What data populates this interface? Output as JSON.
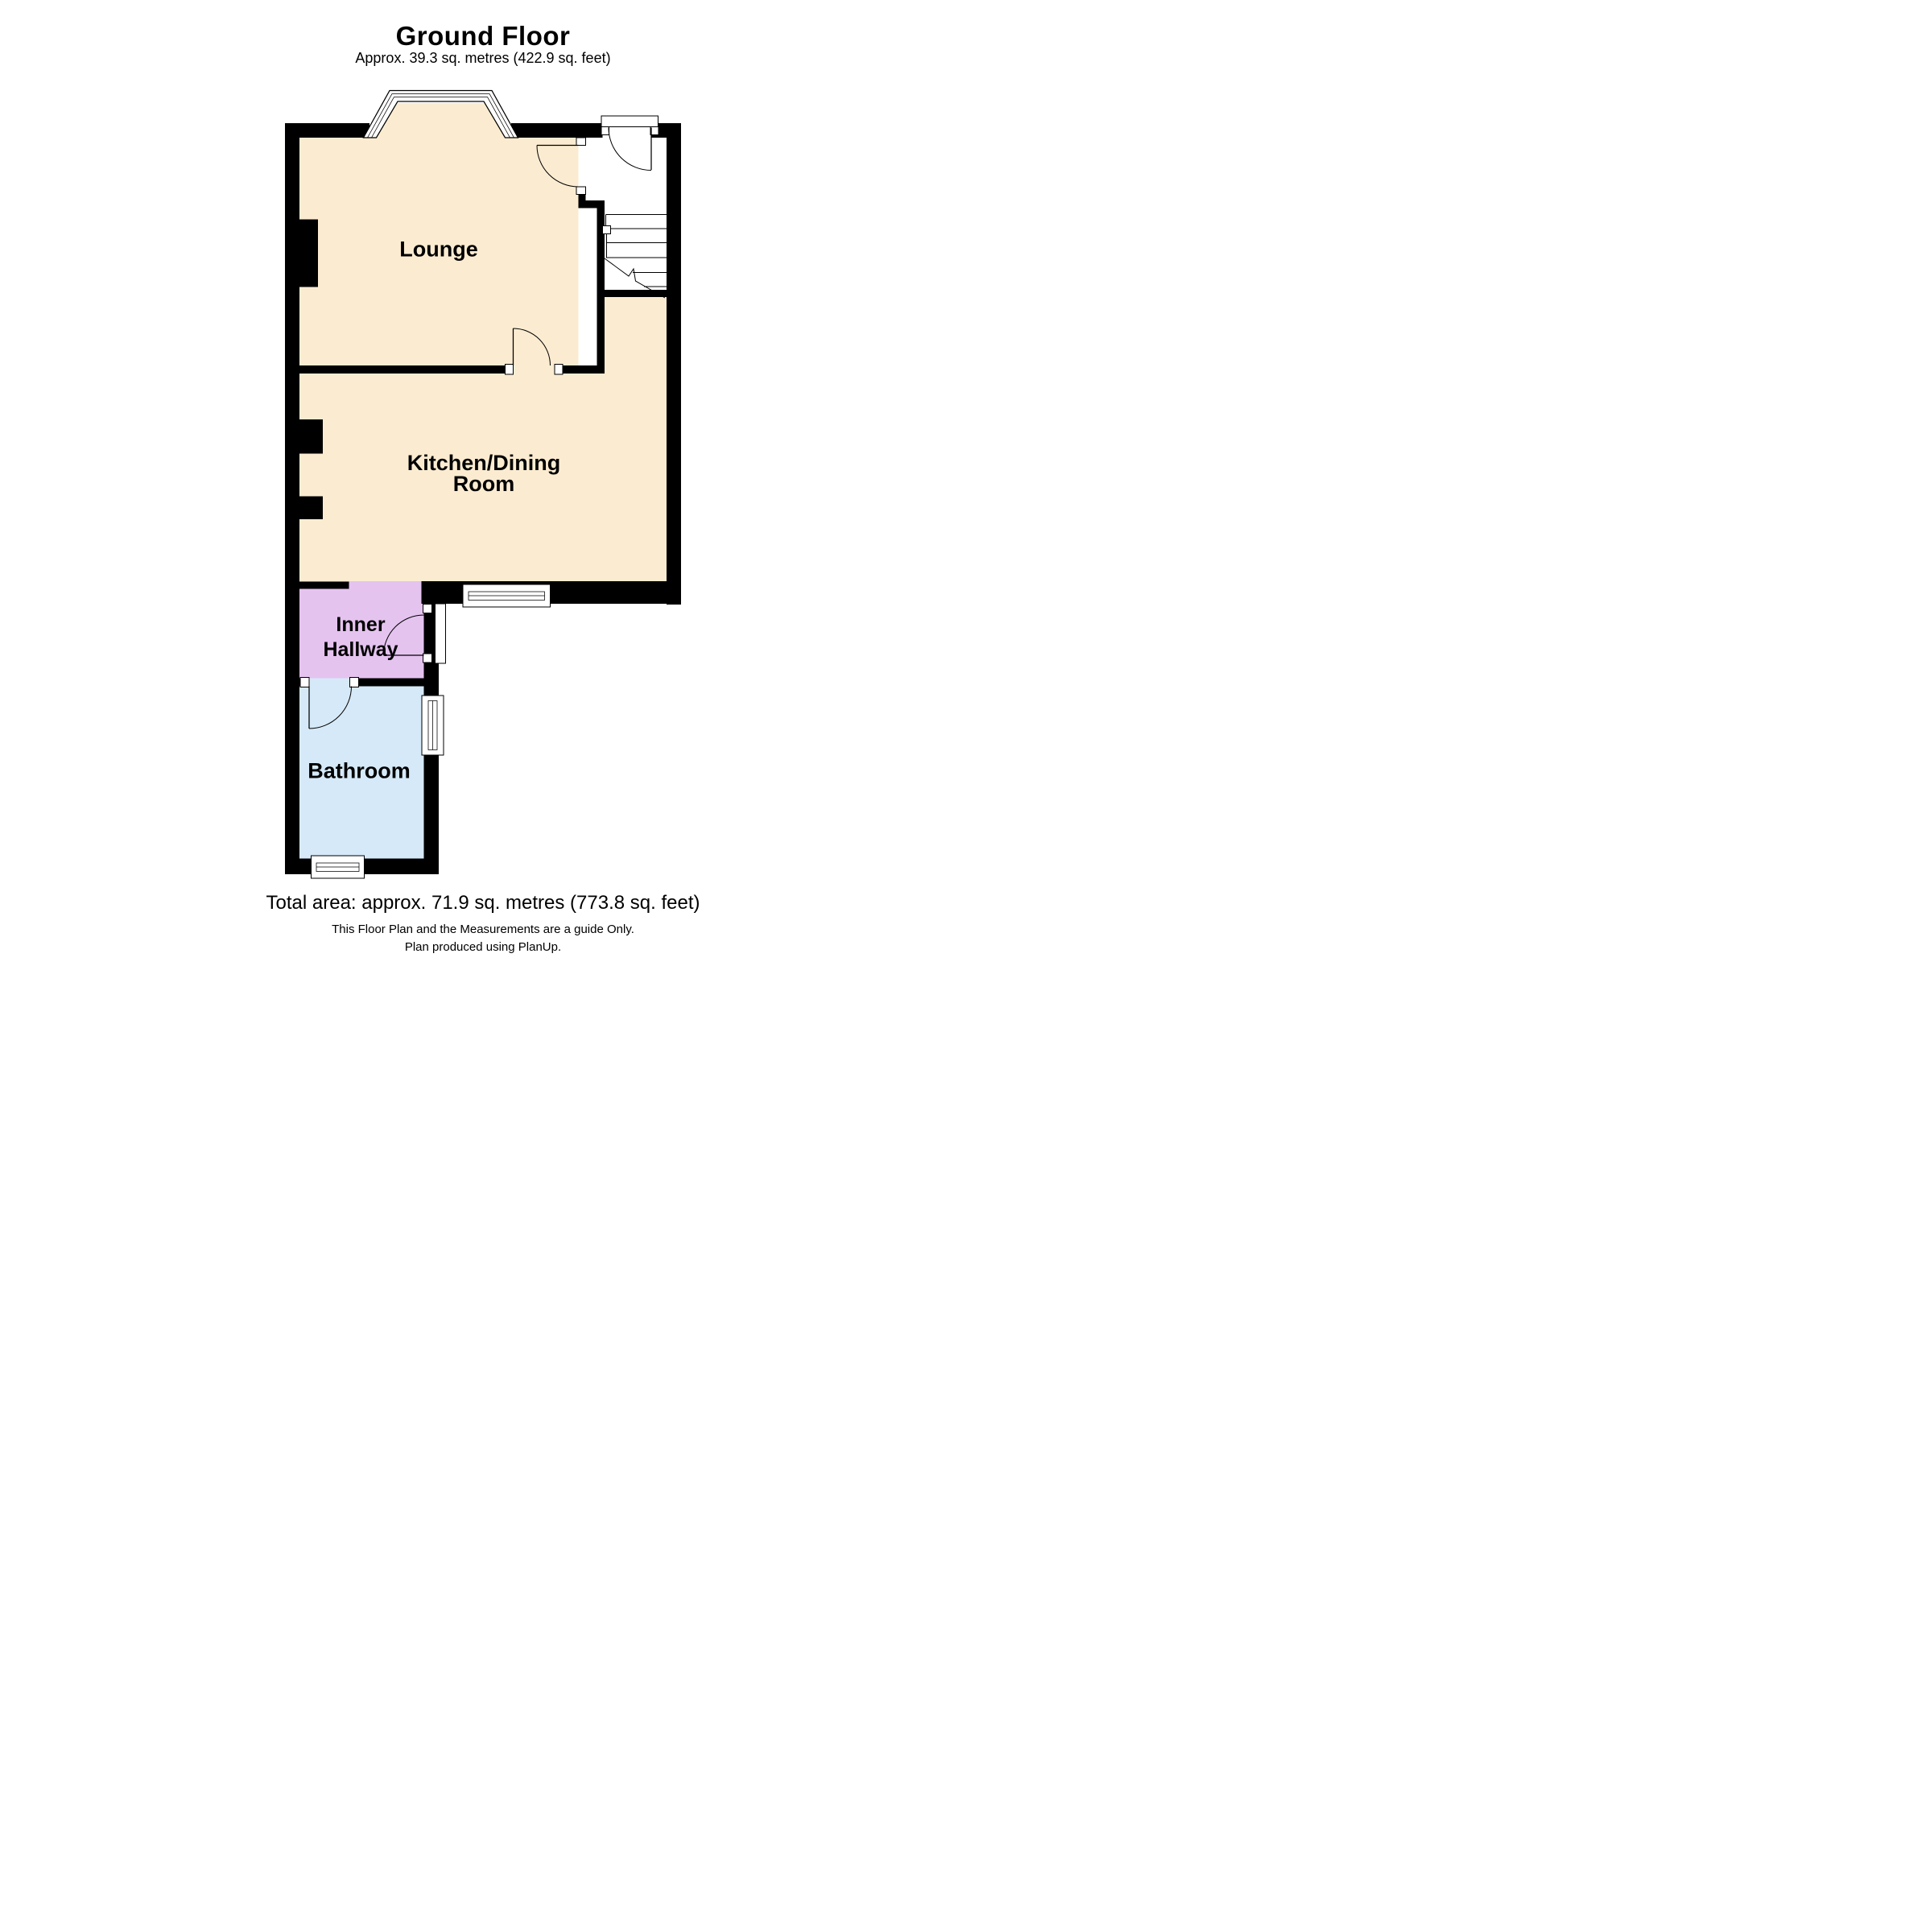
{
  "header": {
    "title": "Ground Floor",
    "subtitle": "Approx. 39.3 sq. metres (422.9 sq. feet)"
  },
  "rooms": {
    "lounge": {
      "label": "Lounge",
      "color": "#fbecd1"
    },
    "kitchen_dining": {
      "label_line1": "Kitchen/Dining",
      "label_line2": "Room",
      "color": "#fbecd1"
    },
    "inner_hallway": {
      "label_line1": "Inner",
      "label_line2": "Hallway",
      "color": "#e5c3ef"
    },
    "bathroom": {
      "label": "Bathroom",
      "color": "#d6e9f8"
    }
  },
  "plan": {
    "wall_color": "#000000",
    "line_color": "#000000",
    "floor_white": "#ffffff"
  },
  "footer": {
    "total_area": "Total area: approx. 71.9 sq. metres (773.8 sq. feet)",
    "disclaimer": "This Floor Plan and the Measurements are a guide Only.",
    "produced": "Plan produced using PlanUp."
  }
}
